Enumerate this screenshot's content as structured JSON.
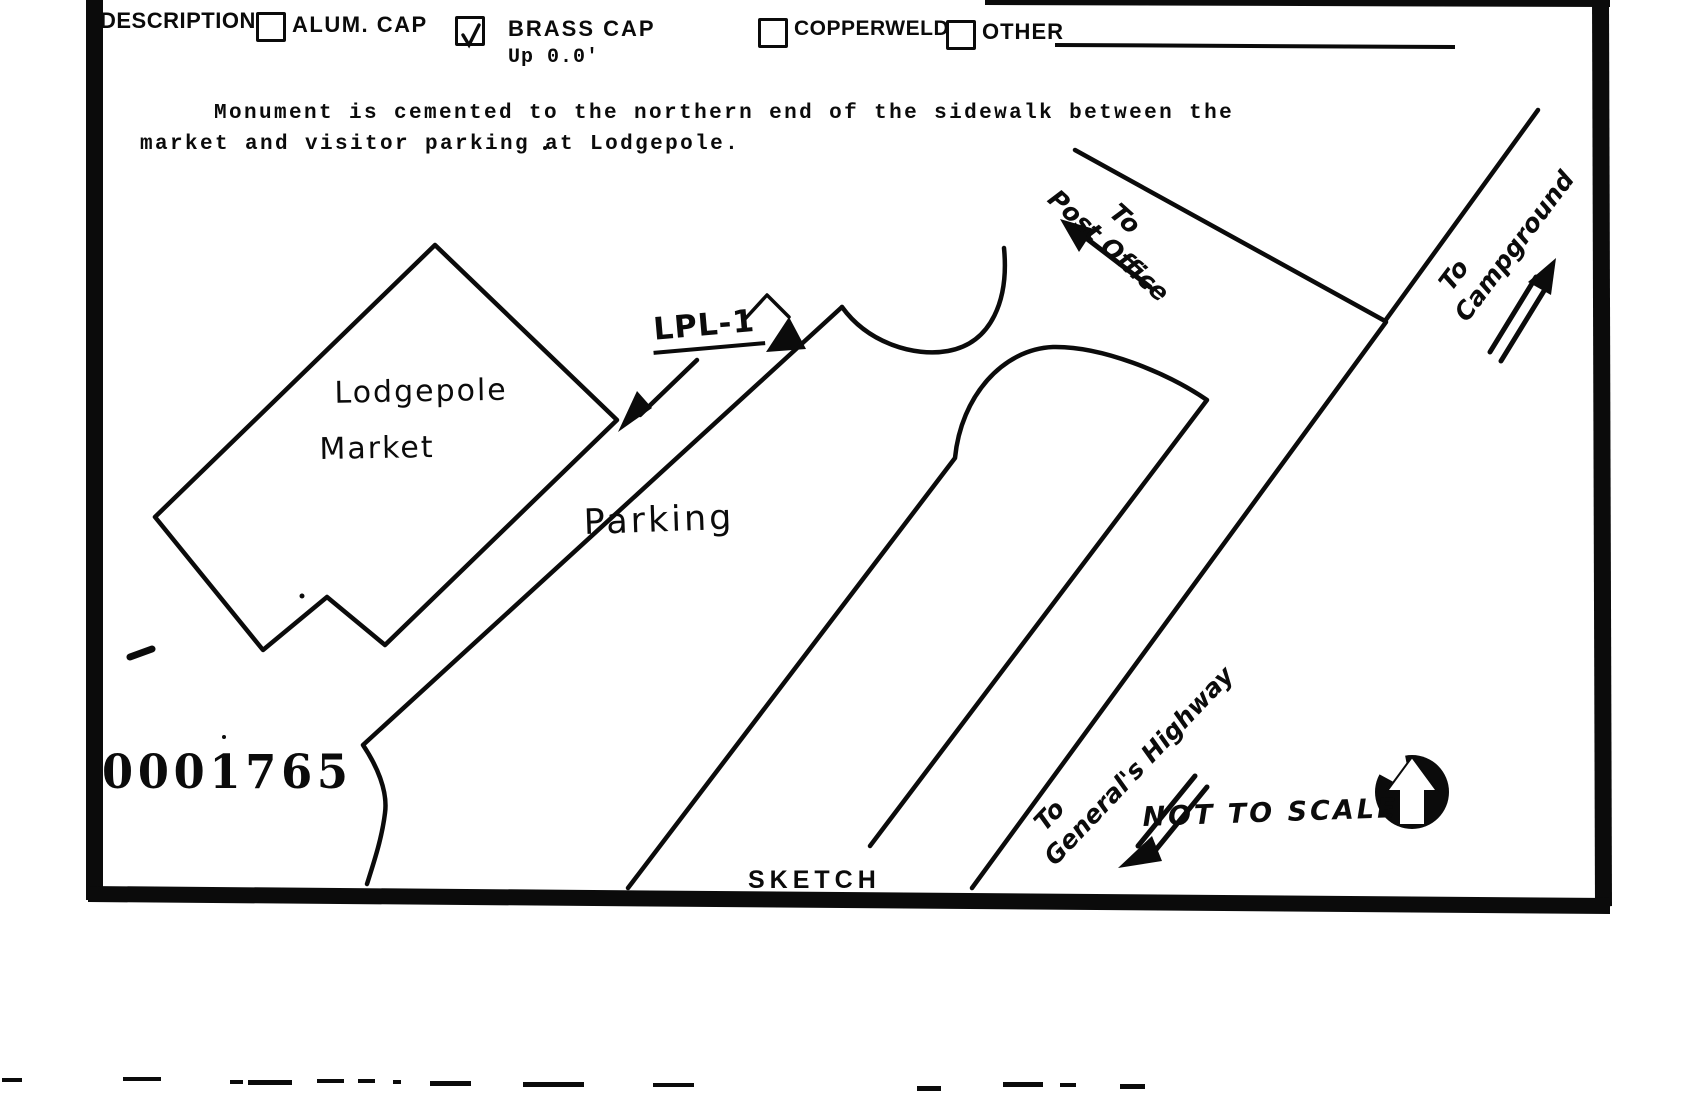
{
  "page": {
    "paper_color": "#ffffff",
    "ink_color": "#0b0b0b"
  },
  "form": {
    "description_label": "DESCRIPTION:",
    "checkboxes": [
      {
        "label": "ALUM. CAP",
        "checked": false
      },
      {
        "label": "BRASS CAP",
        "checked": true,
        "note": "Up 0.0'"
      },
      {
        "label": "COPPERWELD",
        "checked": false
      },
      {
        "label": "OTHER",
        "checked": false,
        "fill_in_value": ""
      }
    ],
    "narrative_line1": "Monument is cemented to the northern end of the sidewalk between the",
    "narrative_line2": "market and visitor parking at Lodgepole.",
    "stamp_number": "0001765",
    "sketch_caption": "SKETCH",
    "scale_note": "NOT TO SCALE"
  },
  "sketch": {
    "building": {
      "line1": "Lodgepole",
      "line2": "Market"
    },
    "parking_label": "Parking",
    "monument_label": "LPL-1",
    "roads": {
      "post_office": {
        "line1": "To",
        "line2": "Post Office"
      },
      "campground": {
        "line1": "To",
        "line2": "Campground"
      },
      "generals_highway": {
        "line1": "To",
        "line2": "General's Highway"
      }
    },
    "icons": {
      "north": "north-arrow-icon",
      "monument": "monument-triangle-icon",
      "check": "check-mark-icon"
    }
  }
}
